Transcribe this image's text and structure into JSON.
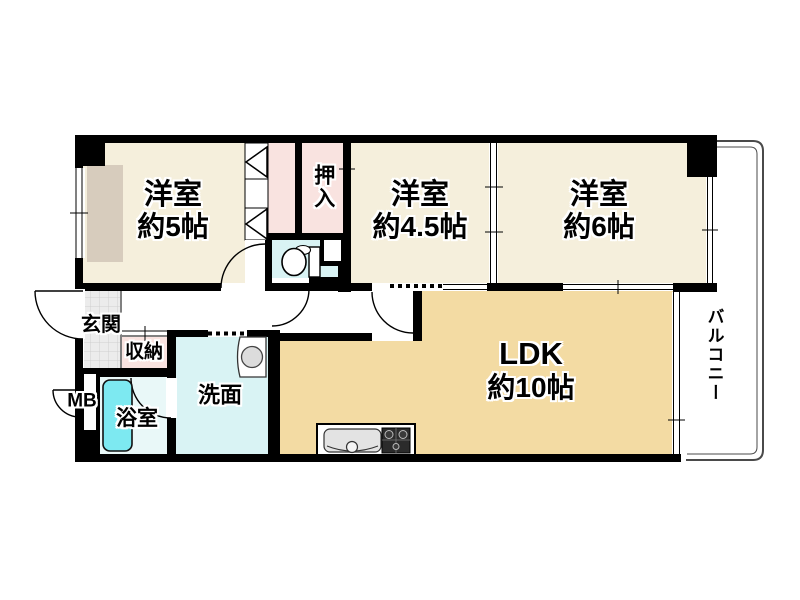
{
  "rooms": {
    "bedroom5": {
      "name": "洋室",
      "size": "約5帖"
    },
    "oshiire": {
      "name": "押入"
    },
    "bedroom45": {
      "name": "洋室",
      "size": "約4.5帖"
    },
    "bedroom6": {
      "name": "洋室",
      "size": "約6帖"
    },
    "entrance": {
      "name": "玄関"
    },
    "storage": {
      "name": "収納"
    },
    "meterBox": {
      "name": "MB"
    },
    "bath": {
      "name": "浴室"
    },
    "washroom": {
      "name": "洗面"
    },
    "ldk": {
      "name": "LDK",
      "size": "約10帖"
    },
    "balcony": {
      "name": "バルコニー"
    }
  },
  "colors": {
    "wall": "#000000",
    "room": "#f5efdc",
    "closet": "#f9e3e0",
    "wet": "#d9f3f4",
    "bathFloor": "#e9f8f8",
    "tub": "#7de9f1",
    "ldk": "#f3dba3",
    "bay": "#d7ccbd",
    "tile": "#ececec"
  }
}
